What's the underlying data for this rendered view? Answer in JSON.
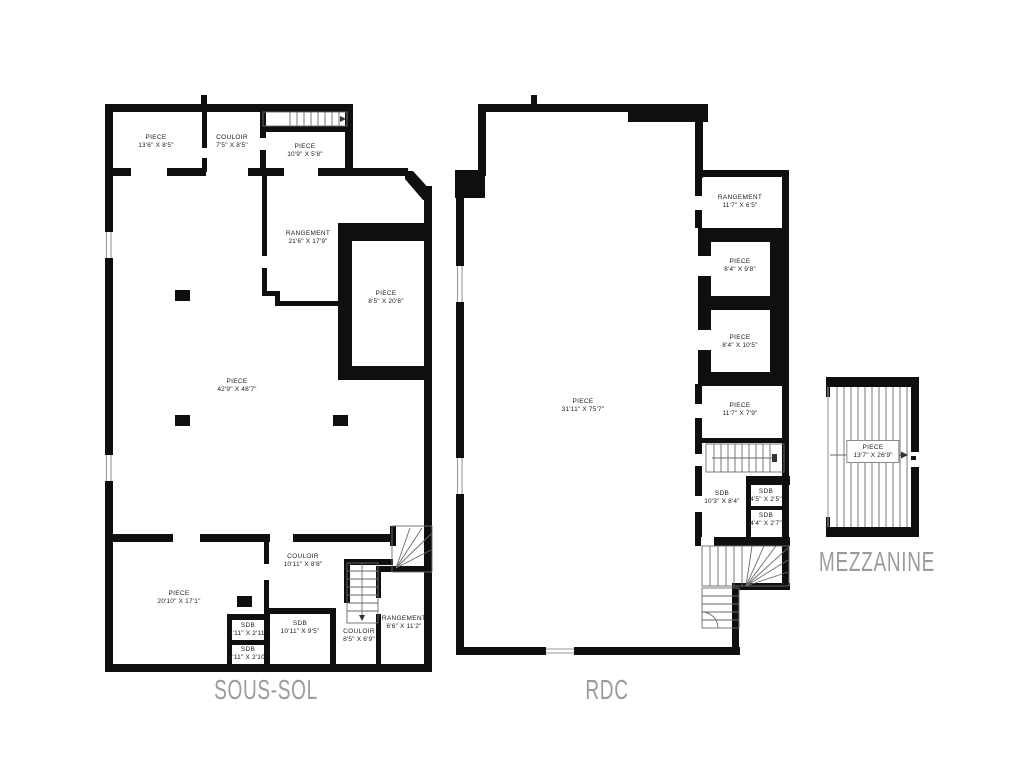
{
  "document": {
    "type": "floor-plan-sheet",
    "language": "French",
    "background_color": "#ffffff"
  },
  "colors": {
    "wall": "#0f0f0f",
    "thin_line": "#6a6a6a",
    "room_text": "#1c1c1c",
    "title_text": "#9b9b9b"
  },
  "plans": {
    "sous_sol": {
      "title": "SOUS-SOL",
      "rooms": [
        {
          "name": "PIECE",
          "dims": "13'6\" X 8'5\""
        },
        {
          "name": "COULOIR",
          "dims": "7'5\" X 8'5\""
        },
        {
          "name": "PIECE",
          "dims": "10'9\" X 5'8\""
        },
        {
          "name": "RANGEMENT",
          "dims": "21'6\" X 17'9\""
        },
        {
          "name": "PIECE",
          "dims": "8'5\" X 20'6\""
        },
        {
          "name": "PIECE",
          "dims": "42'9\" X 48'7\""
        },
        {
          "name": "PIECE",
          "dims": "20'10\" X 17'1\""
        },
        {
          "name": "COULOIR",
          "dims": "10'11\" X 8'8\""
        },
        {
          "name": "SDB",
          "dims": "4'11\" X 2'11\""
        },
        {
          "name": "SDB",
          "dims": "10'11\" X 9'5\""
        },
        {
          "name": "SDB",
          "dims": "4'11\" X 2'10\""
        },
        {
          "name": "COULOIR",
          "dims": "8'5\" X 6'9\""
        },
        {
          "name": "RANGEMENT",
          "dims": "6'6\" X 11'2\""
        }
      ]
    },
    "rdc": {
      "title": "RDC",
      "rooms": [
        {
          "name": "PIECE",
          "dims": "31'11\" X 75'7\""
        },
        {
          "name": "RANGEMENT",
          "dims": "11'7\" X 6'5\""
        },
        {
          "name": "PIECE",
          "dims": "8'4\" X 9'8\""
        },
        {
          "name": "PIECE",
          "dims": "8'4\" X 10'5\""
        },
        {
          "name": "PIECE",
          "dims": "11'7\" X 7'9\""
        },
        {
          "name": "SDB",
          "dims": "10'3\" X 8'4\""
        },
        {
          "name": "SDB",
          "dims": "4'5\" X 2'5\""
        },
        {
          "name": "SDB",
          "dims": "4'4\" X 2'7\""
        }
      ]
    },
    "mezzanine": {
      "title": "MEZZANINE",
      "rooms": [
        {
          "name": "PIECE",
          "dims": "13'7\" X 26'9\""
        }
      ]
    }
  }
}
